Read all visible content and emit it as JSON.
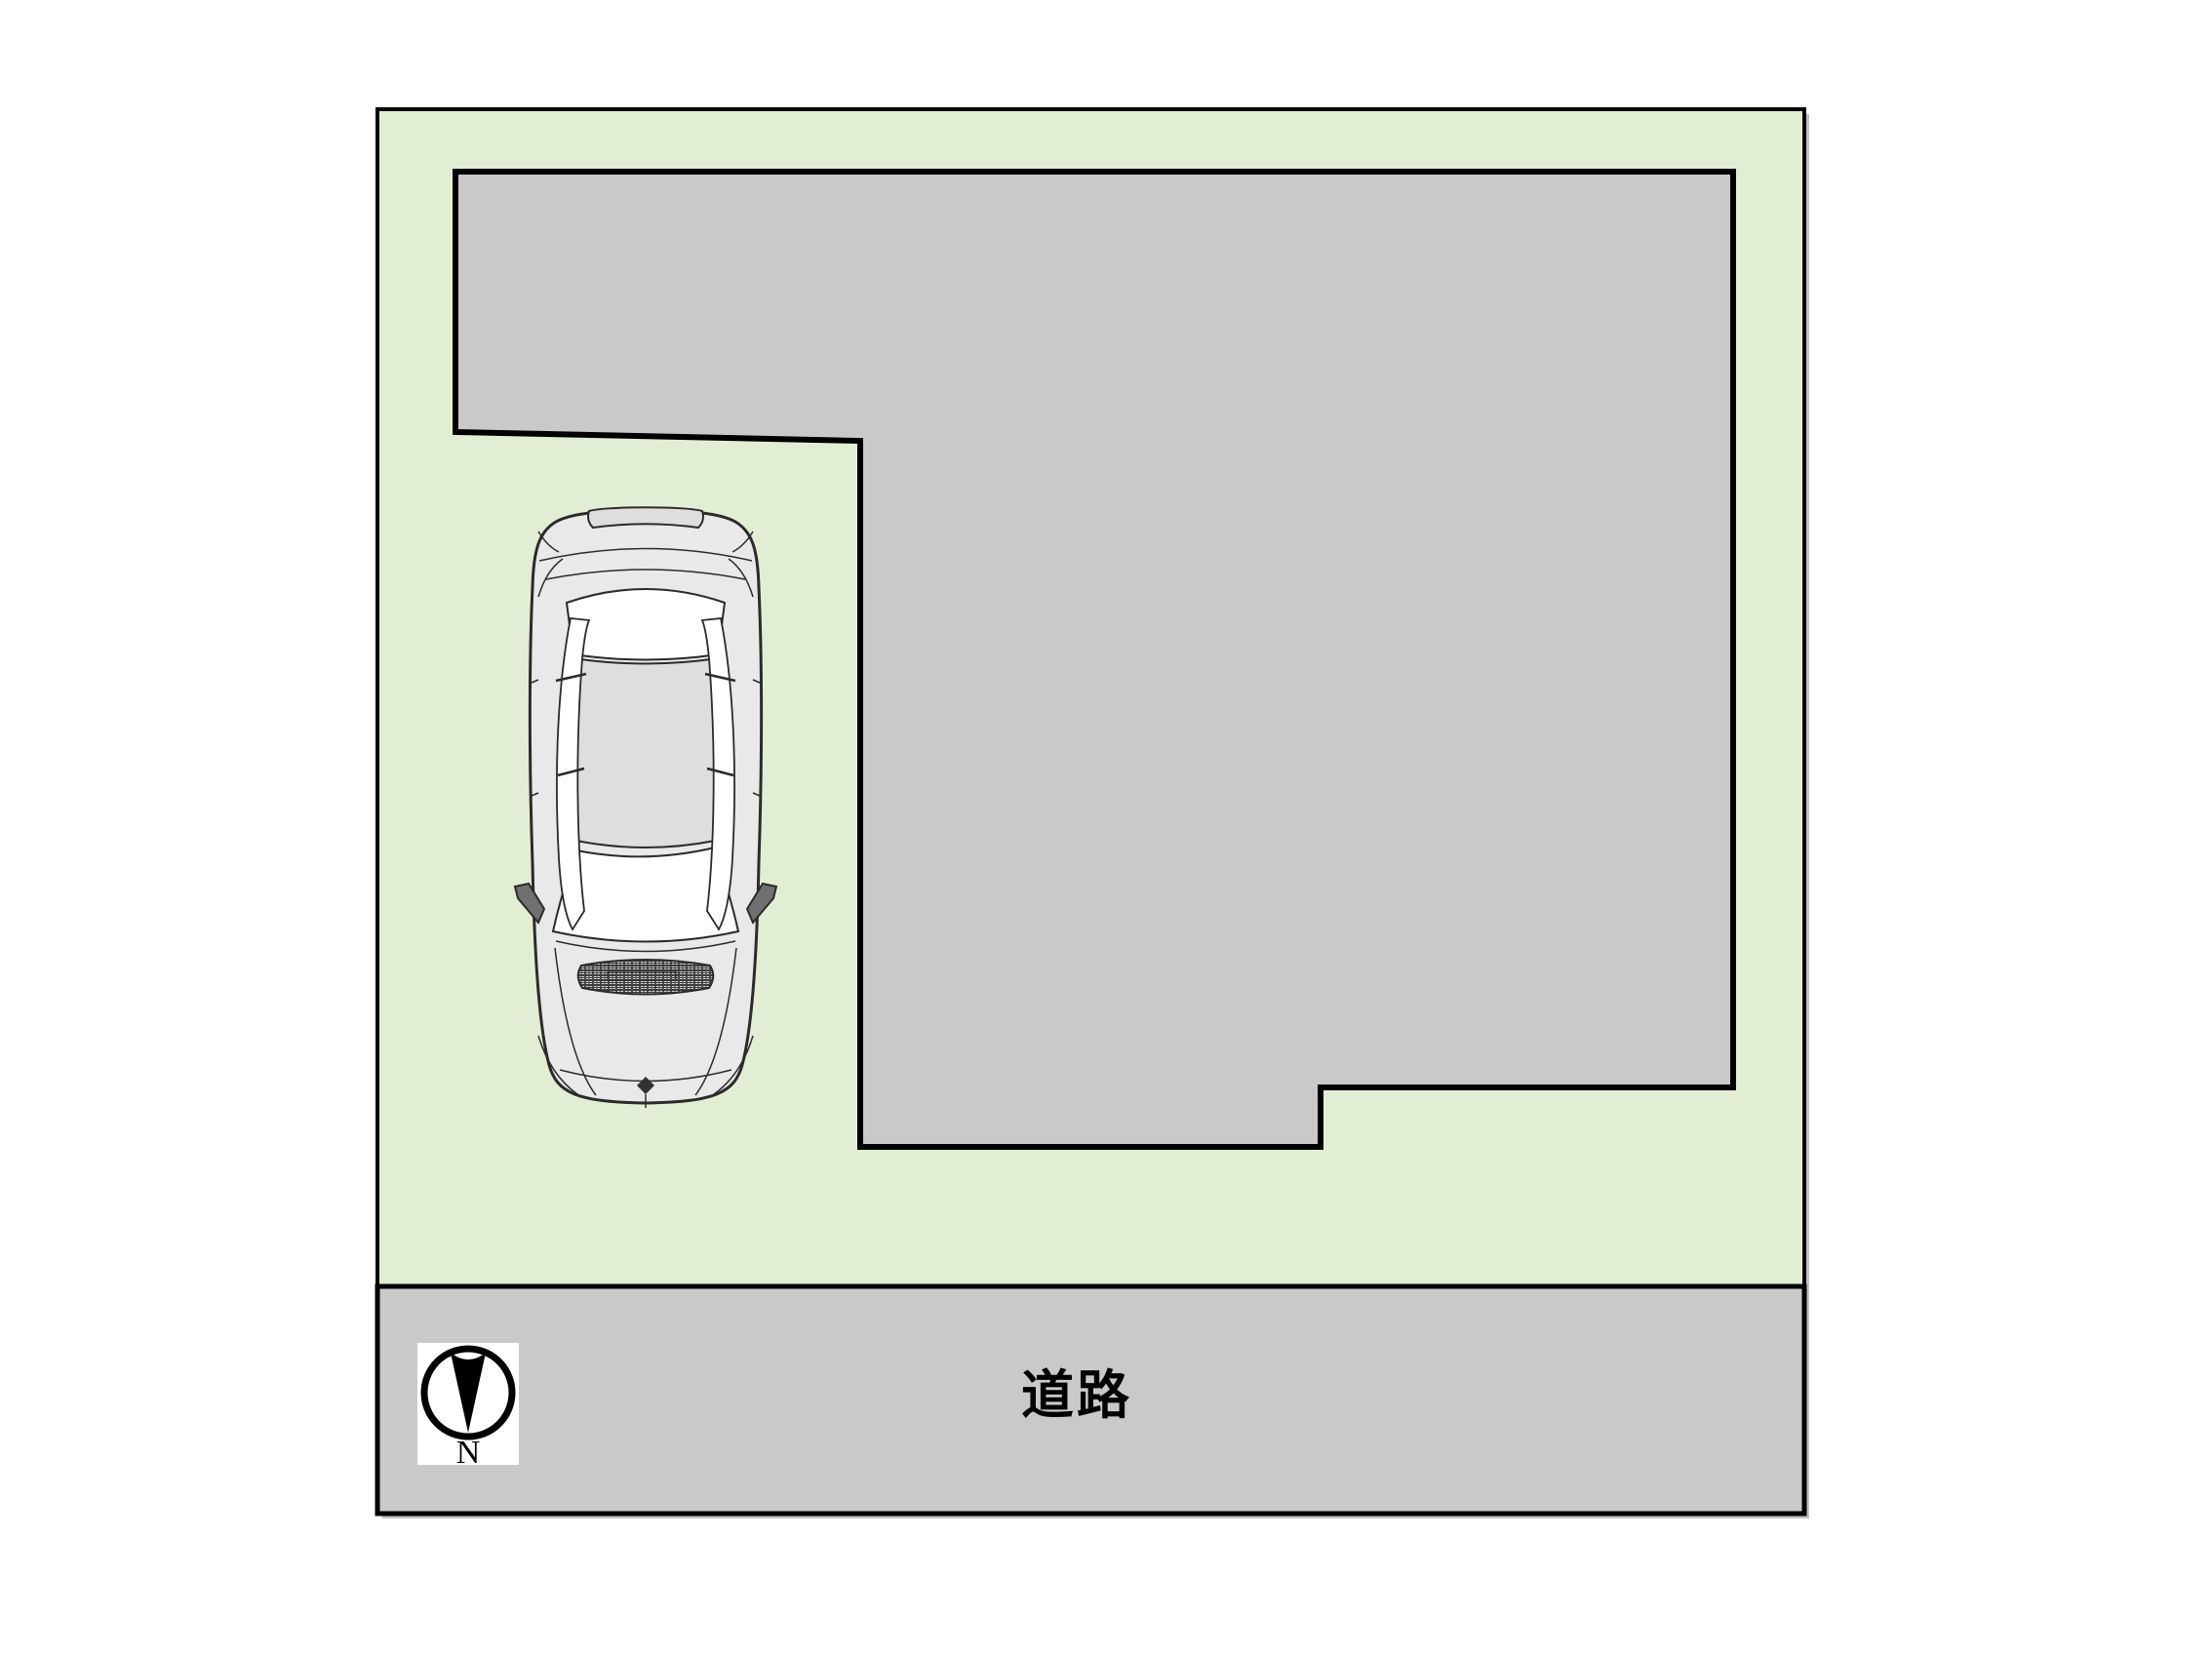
{
  "figure": {
    "type": "site-plan",
    "road_label": "道路",
    "compass_north_label": "N"
  },
  "colors": {
    "canvas_bg": "#ffffff",
    "site_green": "#e1eed3",
    "building_gray": "#c9c9c9",
    "road_gray": "#c9c9c9",
    "outline": "#000000",
    "shadow": "#c2c2c2",
    "car_body": "#e9e9e9",
    "car_panel": "#dedede",
    "car_glass": "#ffffff",
    "car_line": "#2b2b2b",
    "car_mirror": "#707070",
    "car_grille": "#3f3f3f",
    "compass_card": "#ffffff",
    "label_black": "#000000"
  }
}
